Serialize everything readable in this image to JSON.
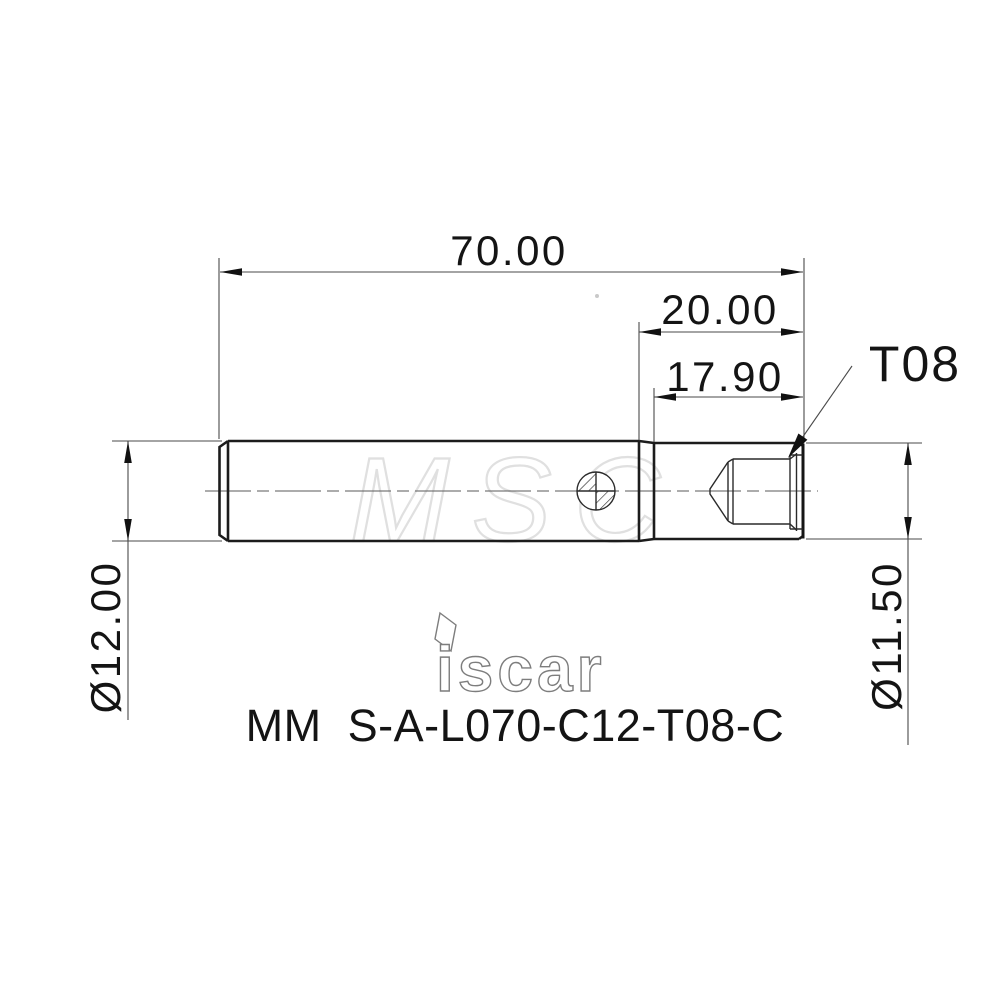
{
  "drawing": {
    "dim_overall_length": "70.00",
    "dim_head_length": "20.00",
    "dim_thread_length": "17.90",
    "label_thread": "T08",
    "dim_shank_diameter": "Ø12.00",
    "dim_head_diameter": "Ø11.50",
    "part_number": "MM  S-A-L070-C12-T08-C",
    "logo": "iscar",
    "watermark": "MSC",
    "colors": {
      "line": "#1c1c1c",
      "dim_line": "#4a4a4a",
      "watermark": "#e0e0e0",
      "background": "#ffffff"
    }
  }
}
